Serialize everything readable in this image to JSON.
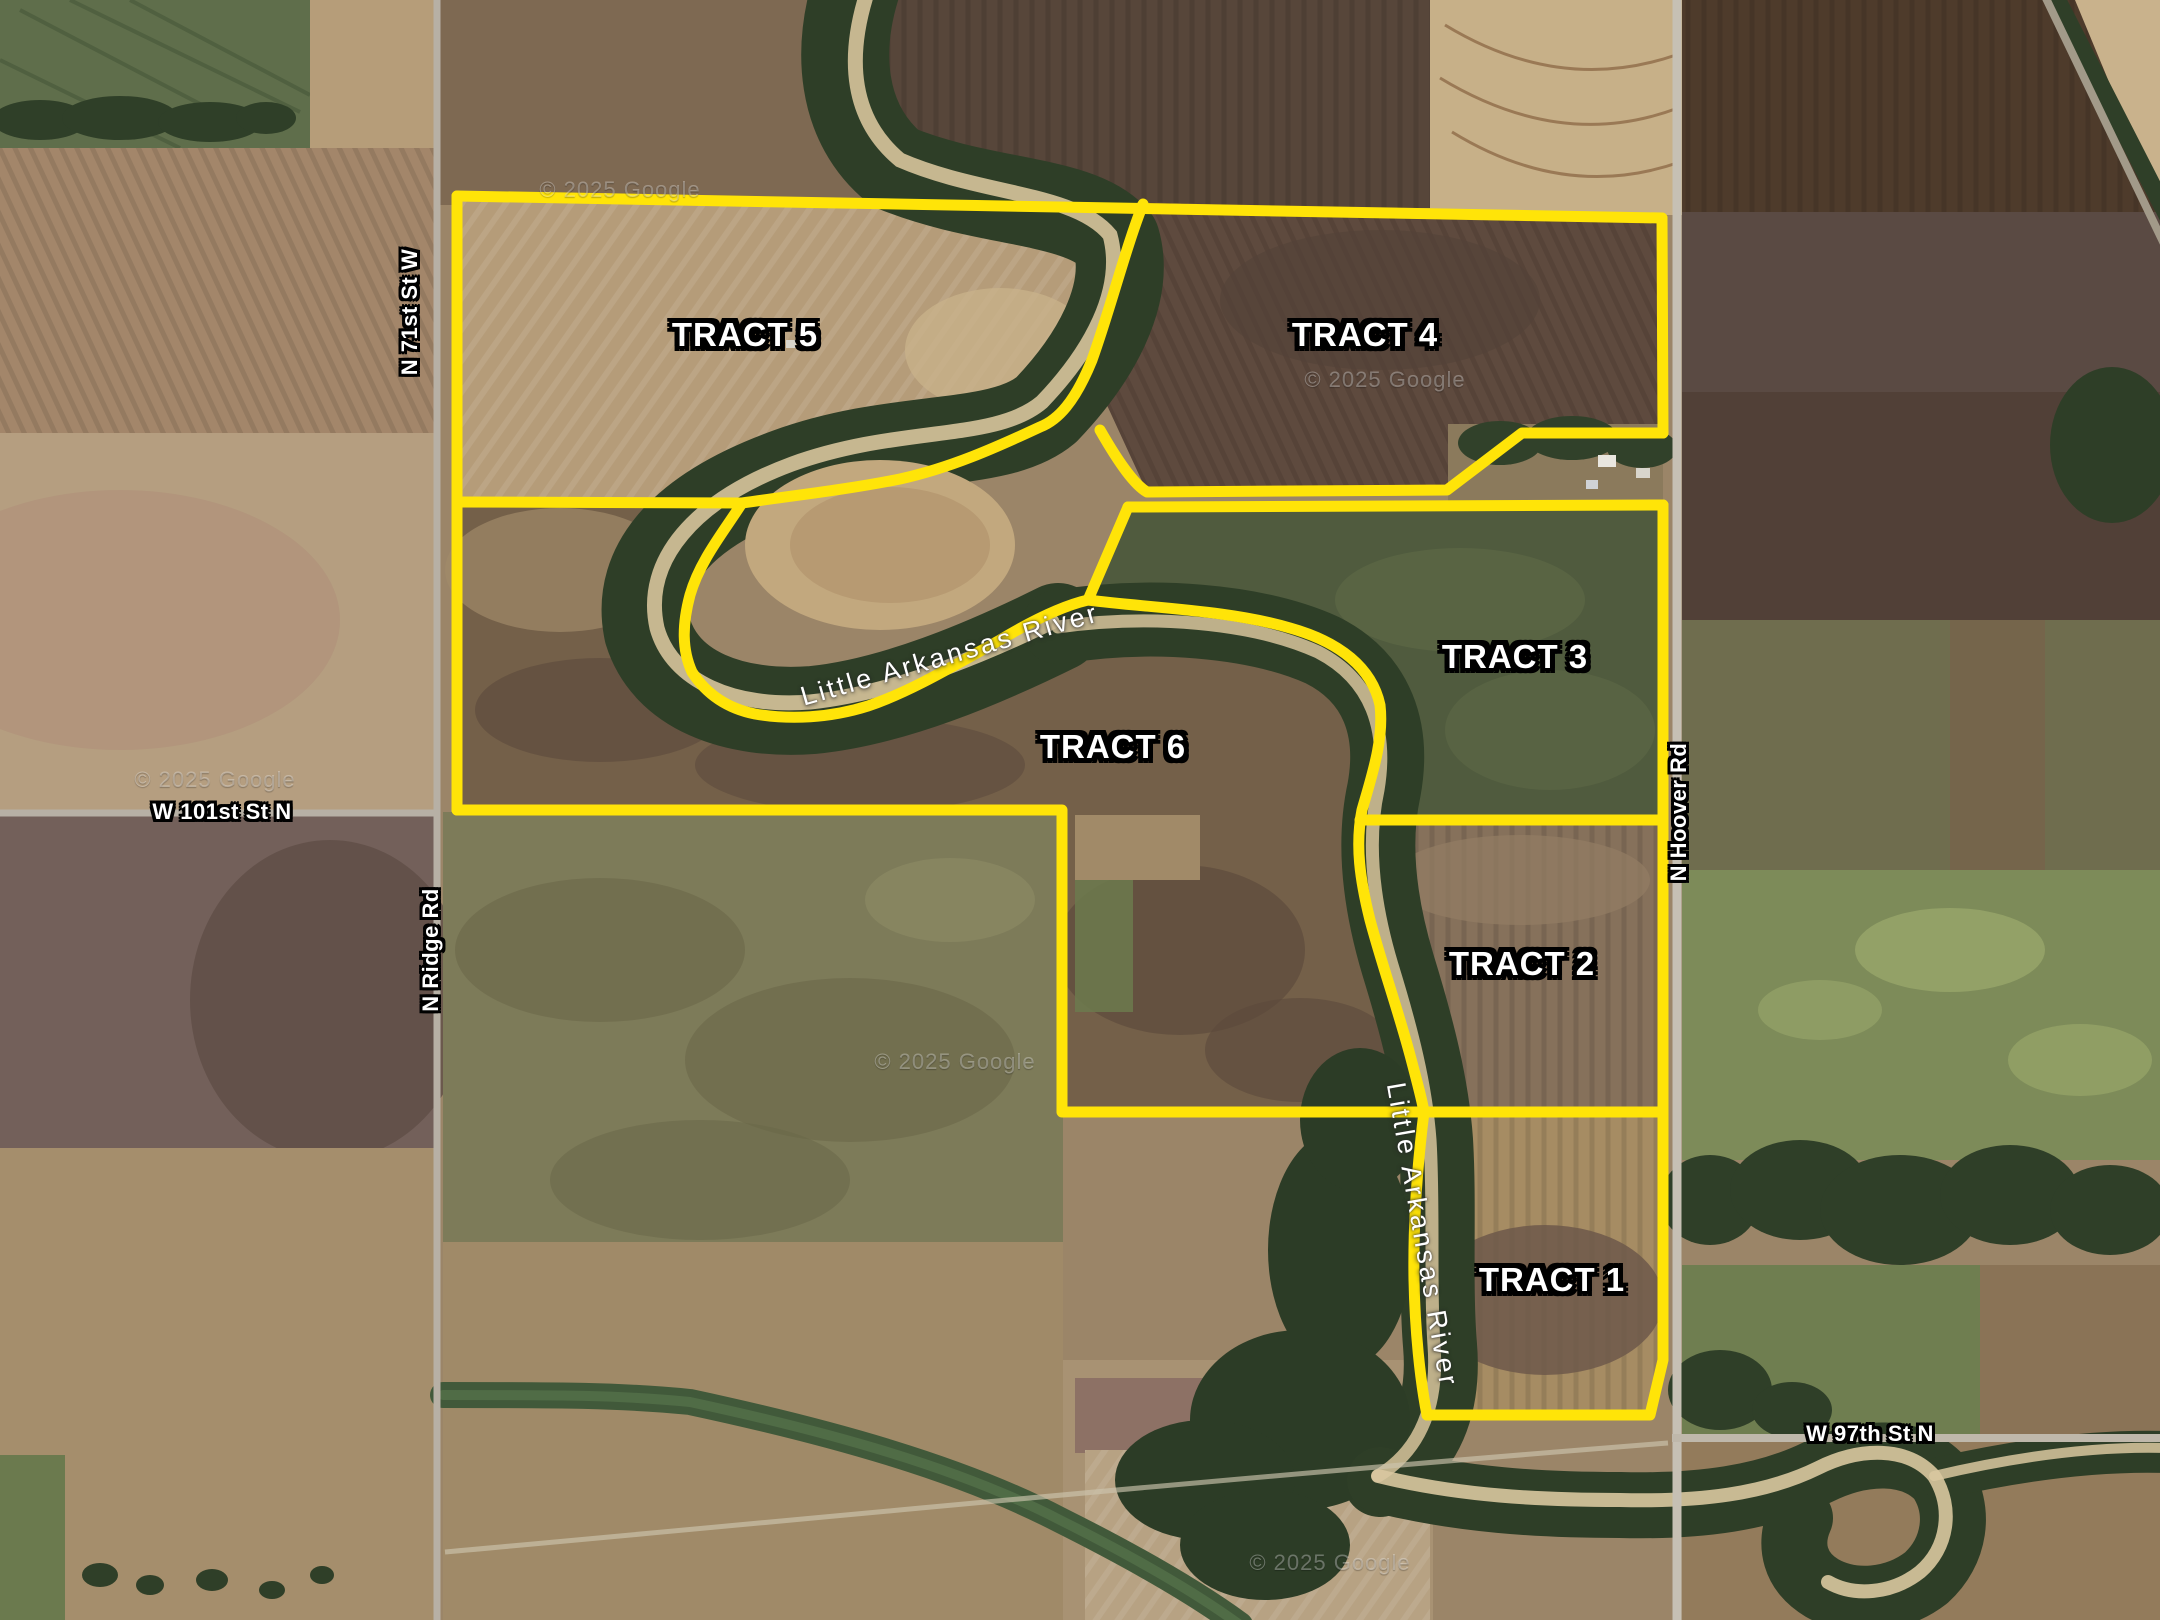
{
  "map": {
    "attribution": "© 2025 Google",
    "river_name": "Little Arkansas River",
    "colors": {
      "boundary_yellow": "#ffe408",
      "label_text": "#ffffff",
      "label_outline": "#000000",
      "road_gray": "#bfb8ab",
      "tree_green": "#2e3e27",
      "river_sand": "#d7c49c"
    },
    "tracts": [
      {
        "name": "TRACT 1"
      },
      {
        "name": "TRACT 2"
      },
      {
        "name": "TRACT 3"
      },
      {
        "name": "TRACT 4"
      },
      {
        "name": "TRACT 5"
      },
      {
        "name": "TRACT 6"
      }
    ],
    "roads": [
      {
        "name": "N 71st St W"
      },
      {
        "name": "N Ridge Rd"
      },
      {
        "name": "W 101st St N"
      },
      {
        "name": "N Hoover Rd"
      },
      {
        "name": "W 97th St N"
      }
    ]
  }
}
